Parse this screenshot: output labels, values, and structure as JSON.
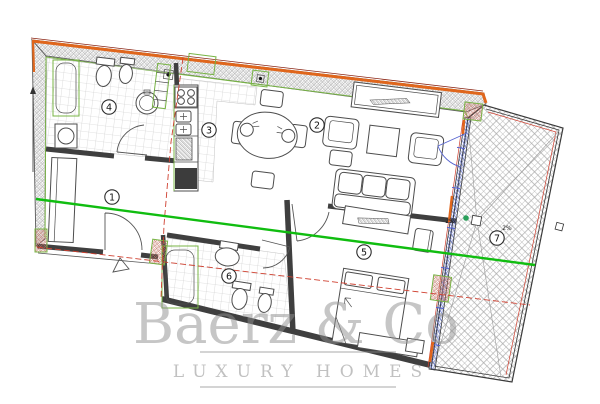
{
  "plan": {
    "room_labels": [
      {
        "label": "1"
      },
      {
        "label": "2"
      },
      {
        "label": "3"
      },
      {
        "label": "4"
      },
      {
        "label": "5"
      },
      {
        "label": "6"
      },
      {
        "label": "7"
      }
    ],
    "slope_labels": [
      {
        "label": "2%"
      },
      {
        "label": "2%"
      }
    ]
  },
  "watermark": {
    "brand": "Baerz & Co",
    "tagline": "LUXURY HOMES"
  },
  "colors": {
    "facade_orange": "#e0661c",
    "section_green": "#10bd10",
    "axis_red": "#cf4030",
    "glazing_blue": "#5563cf",
    "trim_green": "#78b445",
    "wall_dark": "#3f3f3f",
    "watermark_gray": "#8f8f8f"
  }
}
